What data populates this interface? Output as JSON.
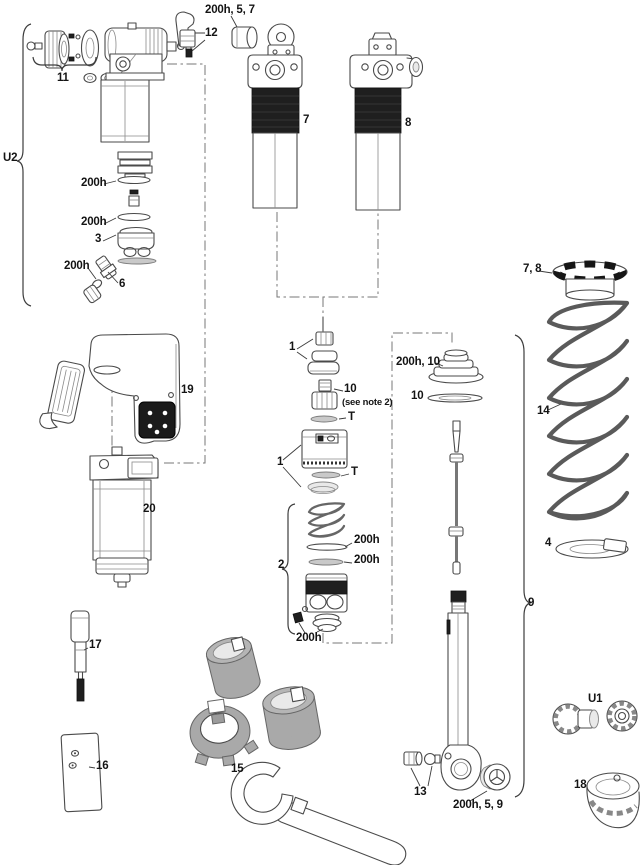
{
  "diagram": {
    "background": "#ffffff",
    "line_color": "#4a4a4a",
    "dark_fill": "#1f1f1f",
    "tool_gray": "#a9a9a9"
  },
  "labels": {
    "upper_bushing": "200h, 5, 7",
    "remote_lever": "12",
    "adjuster_knob_group": "11",
    "u2_group": "U2",
    "shock_left": "7",
    "shock_right": "8",
    "seal_upper": "200h",
    "seal_lower": "200h",
    "piston_head": "3",
    "air_valve_seal": "200h",
    "air_valve": "6",
    "controller": "19",
    "seal_head_group": "1",
    "shaft_fitting": "10",
    "shaft_fitting_note": "(see note 2)",
    "t_ring_upper": "T",
    "air_piston_group": "1",
    "t_ring_lower": "T",
    "negative_spring_group": "2",
    "spring_washer": "200h",
    "spring_seal": "200h",
    "bottom_seal_group": "200h",
    "preload_collar": "7, 8",
    "coil_spring": "14",
    "spring_retainer": "4",
    "damper_shaft_group": "9",
    "bottom_out_bumper": "200h, 10",
    "bumper_washer": "10",
    "reservoir": "20",
    "shaft_clamp_tool": "17",
    "mount_block": "16",
    "tool_kit": "15",
    "shaft_nuts": "13",
    "lower_bushing": "200h, 5, 9",
    "u1_knobs": "U1",
    "knob_cup": "18"
  }
}
